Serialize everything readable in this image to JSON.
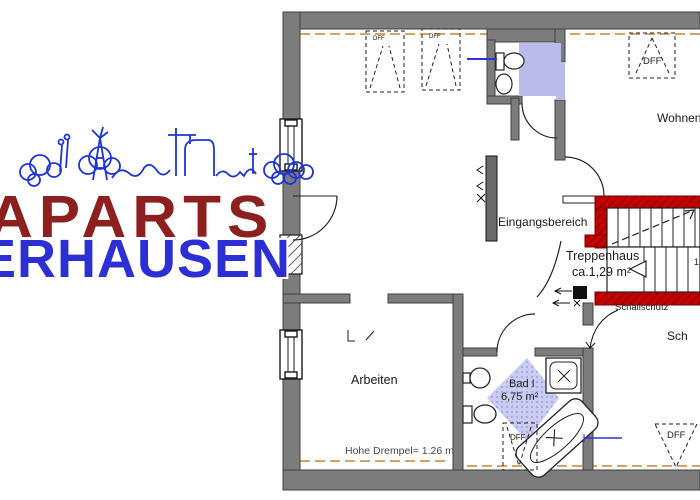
{
  "logo": {
    "line1": "APARTS",
    "line2": "ERHAUSEN"
  },
  "labels": {
    "wohnen": "Wohnen",
    "eingangsbereich": "Eingangsbereich",
    "treppenhaus_title": "Treppenhaus",
    "treppenhaus_area": "ca.1,29 m²",
    "schallschutz": "Schallschutz",
    "schlafen_partial": "Sch",
    "arbeiten": "Arbeiten",
    "bad_title": "Bad I",
    "bad_area": "6,75 m²",
    "drempel": "Hohe Drempel= 1.26 m",
    "stair_step_number": "1",
    "dff": "DFF"
  },
  "colors": {
    "wall_gray": "#7c7c7c",
    "stair_wall_red": "#c90000",
    "lavender": "#b9bce9",
    "drempel_tan": "#d2a46a",
    "logo_red": "#8e1f1f",
    "logo_blue": "#2c2fd4",
    "skyline_blue": "#1d34d6"
  }
}
